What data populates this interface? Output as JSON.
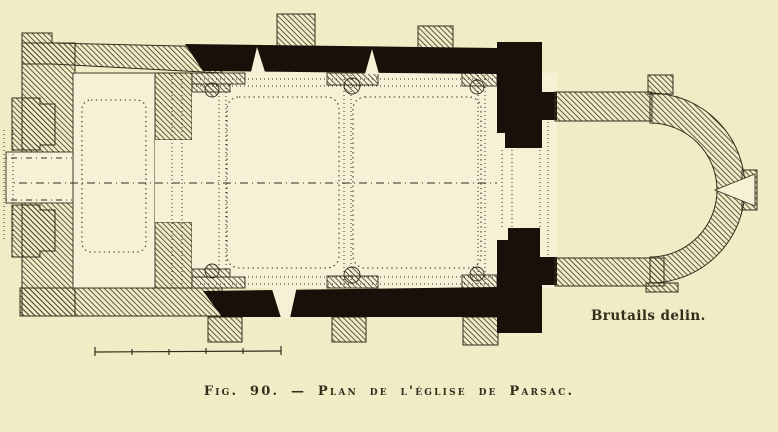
{
  "figure": {
    "caption": "Fig. 90. — Plan de l'église de Parsac.",
    "attribution": "Brutails delin."
  },
  "plan": {
    "subject": "church floor plan",
    "parts": [
      "west-tower",
      "nave",
      "chancel-piers",
      "choir",
      "apse"
    ],
    "scale_bar": {
      "segments": 5
    }
  },
  "colors": {
    "paper": "#f1ebc6",
    "interior": "#f6f1d6",
    "ink": "#352c1b",
    "wall": "#17110a",
    "hatch": "#4b4130"
  }
}
